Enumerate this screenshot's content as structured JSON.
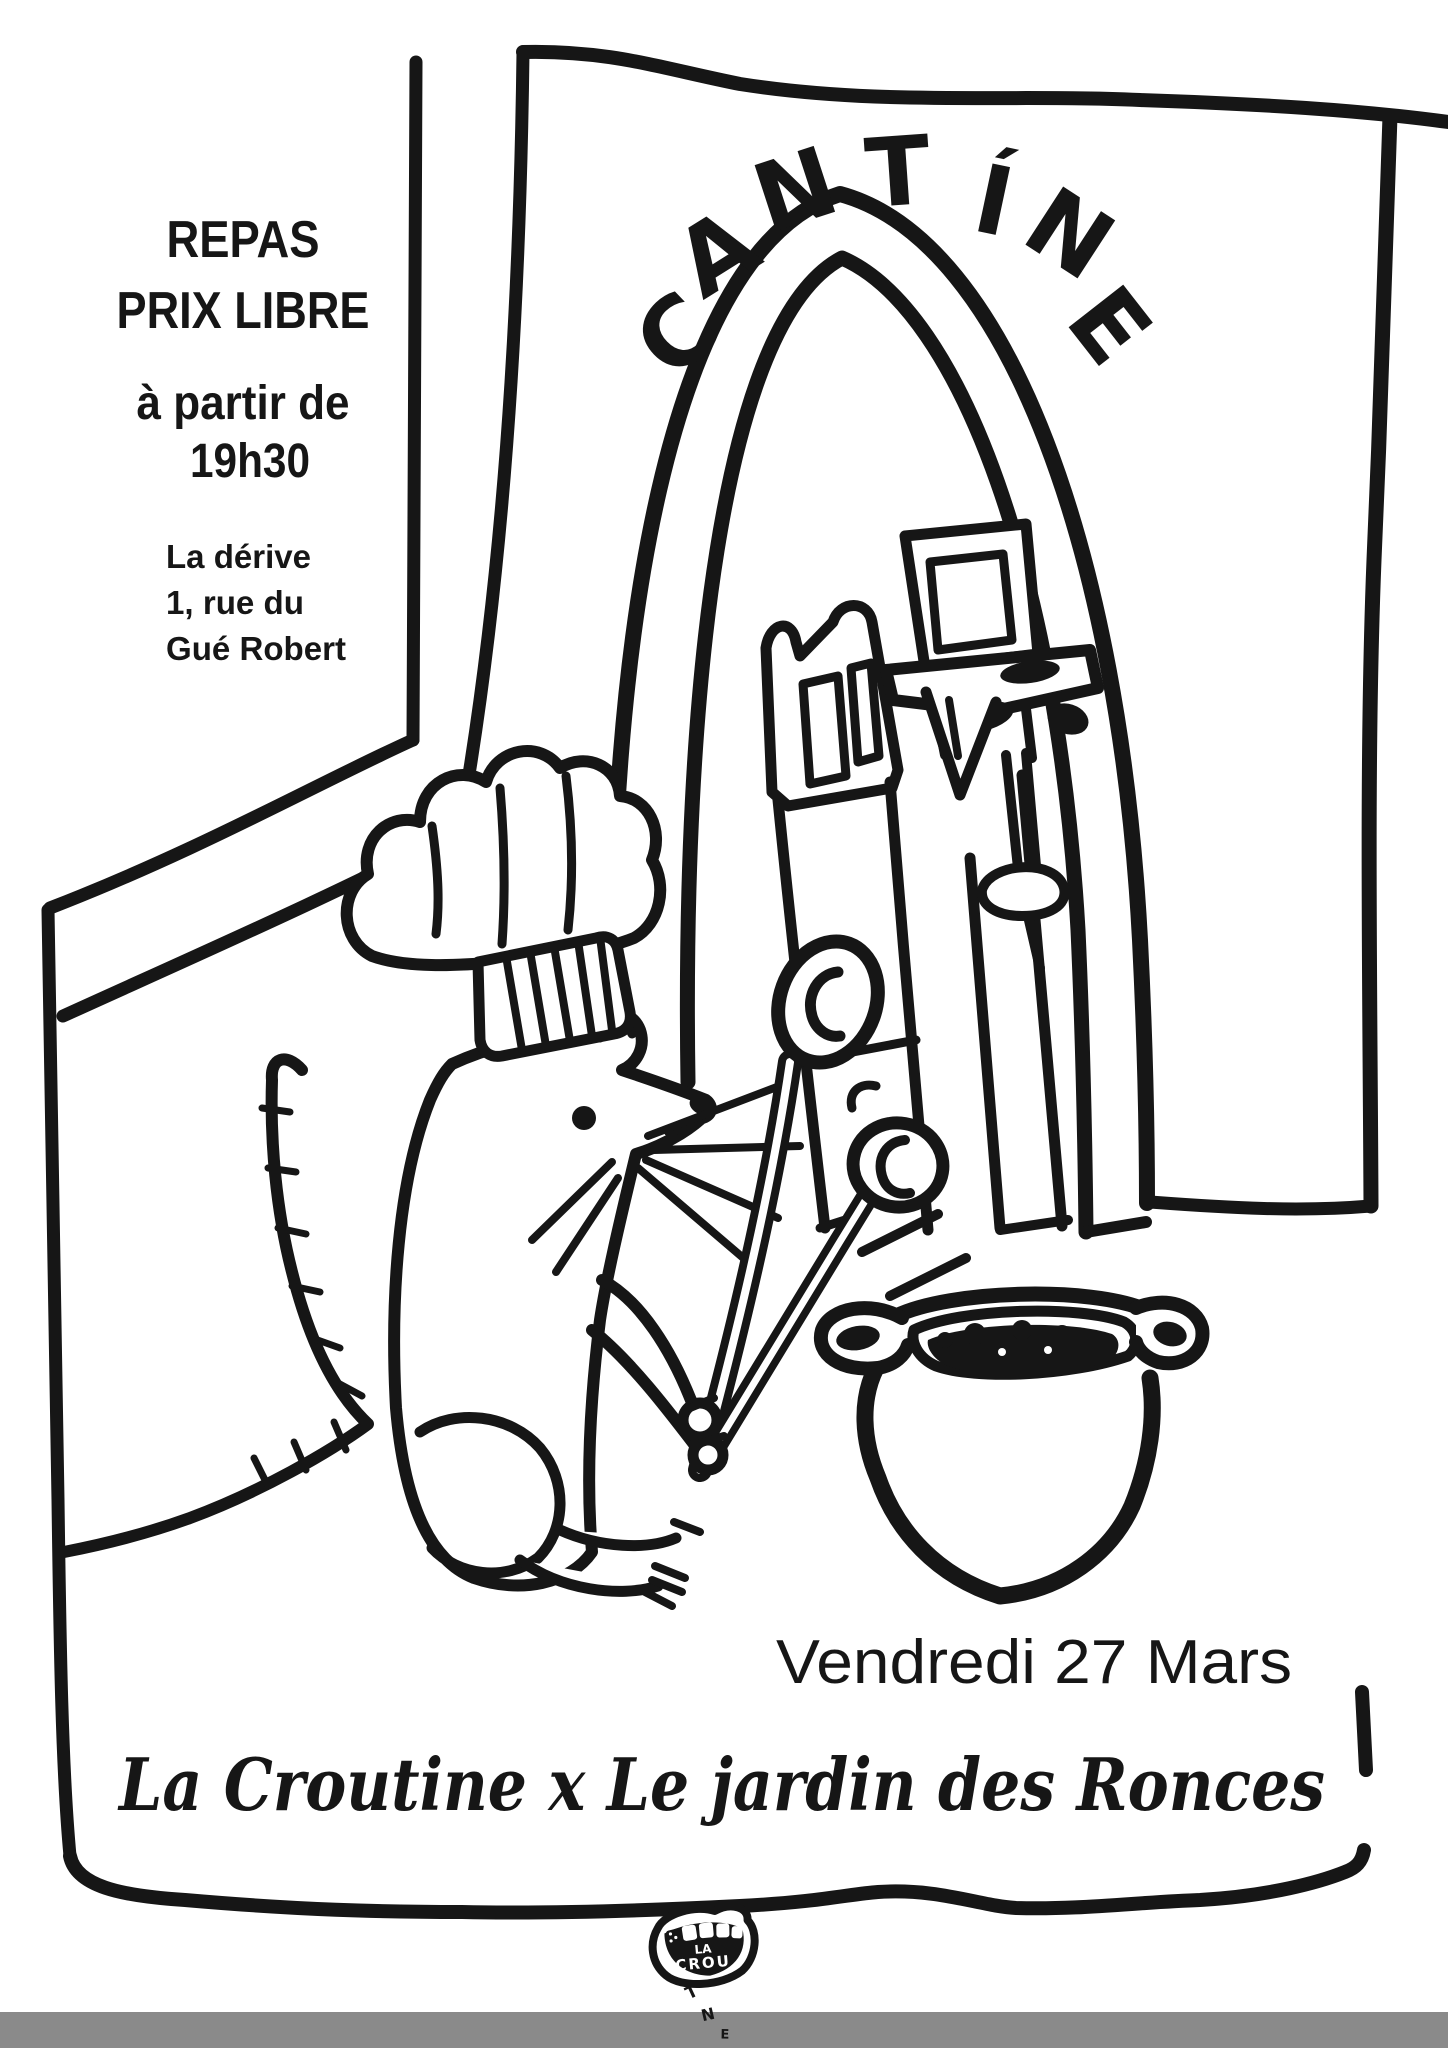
{
  "poster": {
    "top_left": {
      "line1": "REPAS",
      "line2": "PRIX LIBRE",
      "line3": "à partir de",
      "line4": "19h30"
    },
    "venue": {
      "line1": "La dérive",
      "line2": "1, rue du",
      "line3": "Gué Robert"
    },
    "sign": {
      "word": "CANTÍNE",
      "letters": [
        "C",
        "A",
        "N",
        "T",
        "Í",
        "N",
        "E"
      ]
    },
    "date_line": "Vendredi 27 Mars",
    "title_line": "La Croutine x Le jardin des Ronces",
    "logo": {
      "line1": "LA",
      "line2": "CROU",
      "drips": [
        "T",
        "N",
        "E"
      ]
    },
    "colors": {
      "ink": "#161616",
      "paper": "#ffffff",
      "footer_band": "#8a8a8a"
    }
  }
}
